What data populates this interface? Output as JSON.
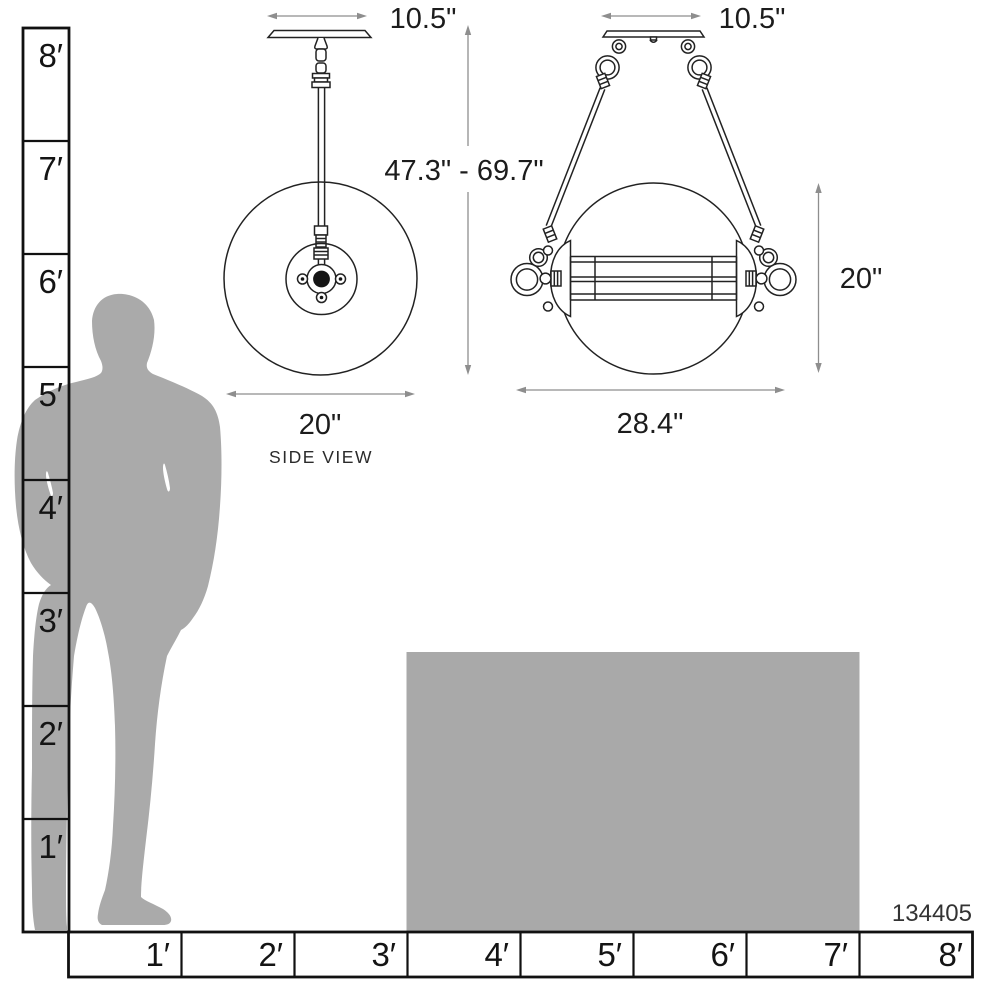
{
  "diagram": {
    "product_code": "134405",
    "side_view": {
      "canopy_width": "10.5\"",
      "diameter": "20\"",
      "label": "SIDE VIEW"
    },
    "front_view": {
      "canopy_width": "10.5\"",
      "hanging_height_range": "47.3\" - 69.7\"",
      "shade_height": "20\"",
      "width": "28.4\""
    },
    "vertical_ruler": {
      "labels": [
        "8′",
        "7′",
        "6′",
        "5′",
        "4′",
        "3′",
        "2′",
        "1′"
      ]
    },
    "horizontal_ruler": {
      "labels": [
        "1′",
        "2′",
        "3′",
        "4′",
        "5′",
        "6′",
        "7′",
        "8′"
      ]
    },
    "colors": {
      "silhouette": "#aaaaaa",
      "table": "#a9a9a9",
      "line_art": "#222222",
      "dimension_lines": "#8e8e8e",
      "text": "#1c1c1c",
      "background": "#ffffff"
    }
  }
}
